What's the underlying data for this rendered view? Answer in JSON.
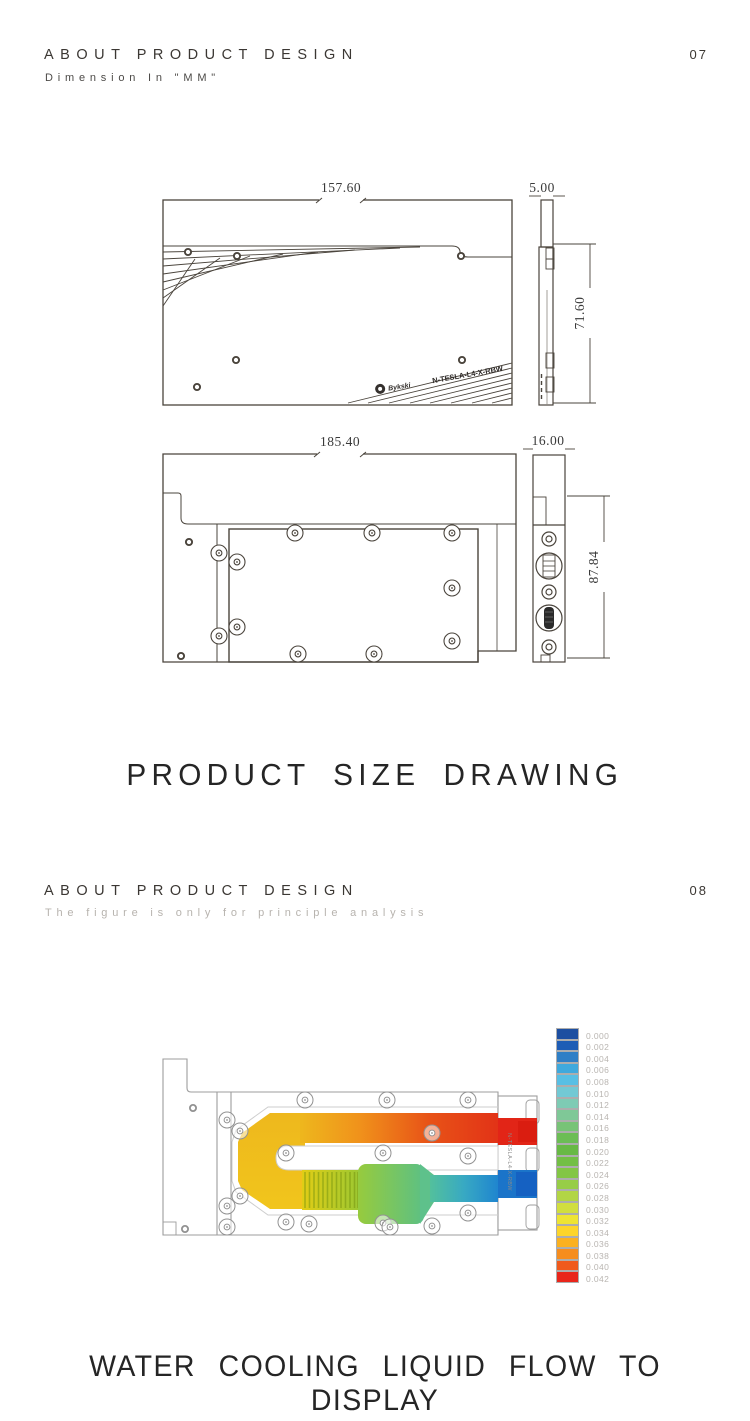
{
  "page1": {
    "header": {
      "title": "ABOUT PRODUCT DESIGN",
      "page_number": "07",
      "subtitle": "Dimension In \"MM\""
    },
    "front_view": {
      "width_dim": "157.60",
      "thickness_dim": "5.00",
      "height_dim": "71.60",
      "brand": "Bykski",
      "model": "N-TESLA-L4-X-RBW"
    },
    "top_view": {
      "width_dim": "185.40",
      "thickness_dim": "16.00",
      "height_dim": "87.84"
    },
    "caption": "PRODUCT SIZE DRAWING"
  },
  "page2": {
    "header": {
      "title": "ABOUT PRODUCT DESIGN",
      "page_number": "08",
      "subtitle": "The figure is only for principle analysis"
    },
    "model_label": "N-TESLA-L4-X-RBW",
    "caption": "WATER COOLING LIQUID FLOW TO DISPLAY"
  },
  "chart_data": {
    "type": "heatmap",
    "title": "Liquid flow velocity color scale",
    "legend_position": "right",
    "legend_values": [
      "0.000",
      "0.002",
      "0.004",
      "0.006",
      "0.008",
      "0.010",
      "0.012",
      "0.014",
      "0.016",
      "0.018",
      "0.020",
      "0.022",
      "0.024",
      "0.026",
      "0.028",
      "0.030",
      "0.032",
      "0.034",
      "0.036",
      "0.038",
      "0.040",
      "0.042"
    ],
    "legend_colors": [
      "#1d4fa1",
      "#1e5db5",
      "#2f7fc6",
      "#3fa9dd",
      "#58bfe4",
      "#72c9d4",
      "#7ecbb4",
      "#7fc897",
      "#78c377",
      "#6cbd55",
      "#68b945",
      "#73bf45",
      "#83c645",
      "#97cd47",
      "#b2d545",
      "#d1de3e",
      "#eee433",
      "#fdd52a",
      "#fbb120",
      "#f68d1e",
      "#f05a1c",
      "#e9261b"
    ]
  }
}
